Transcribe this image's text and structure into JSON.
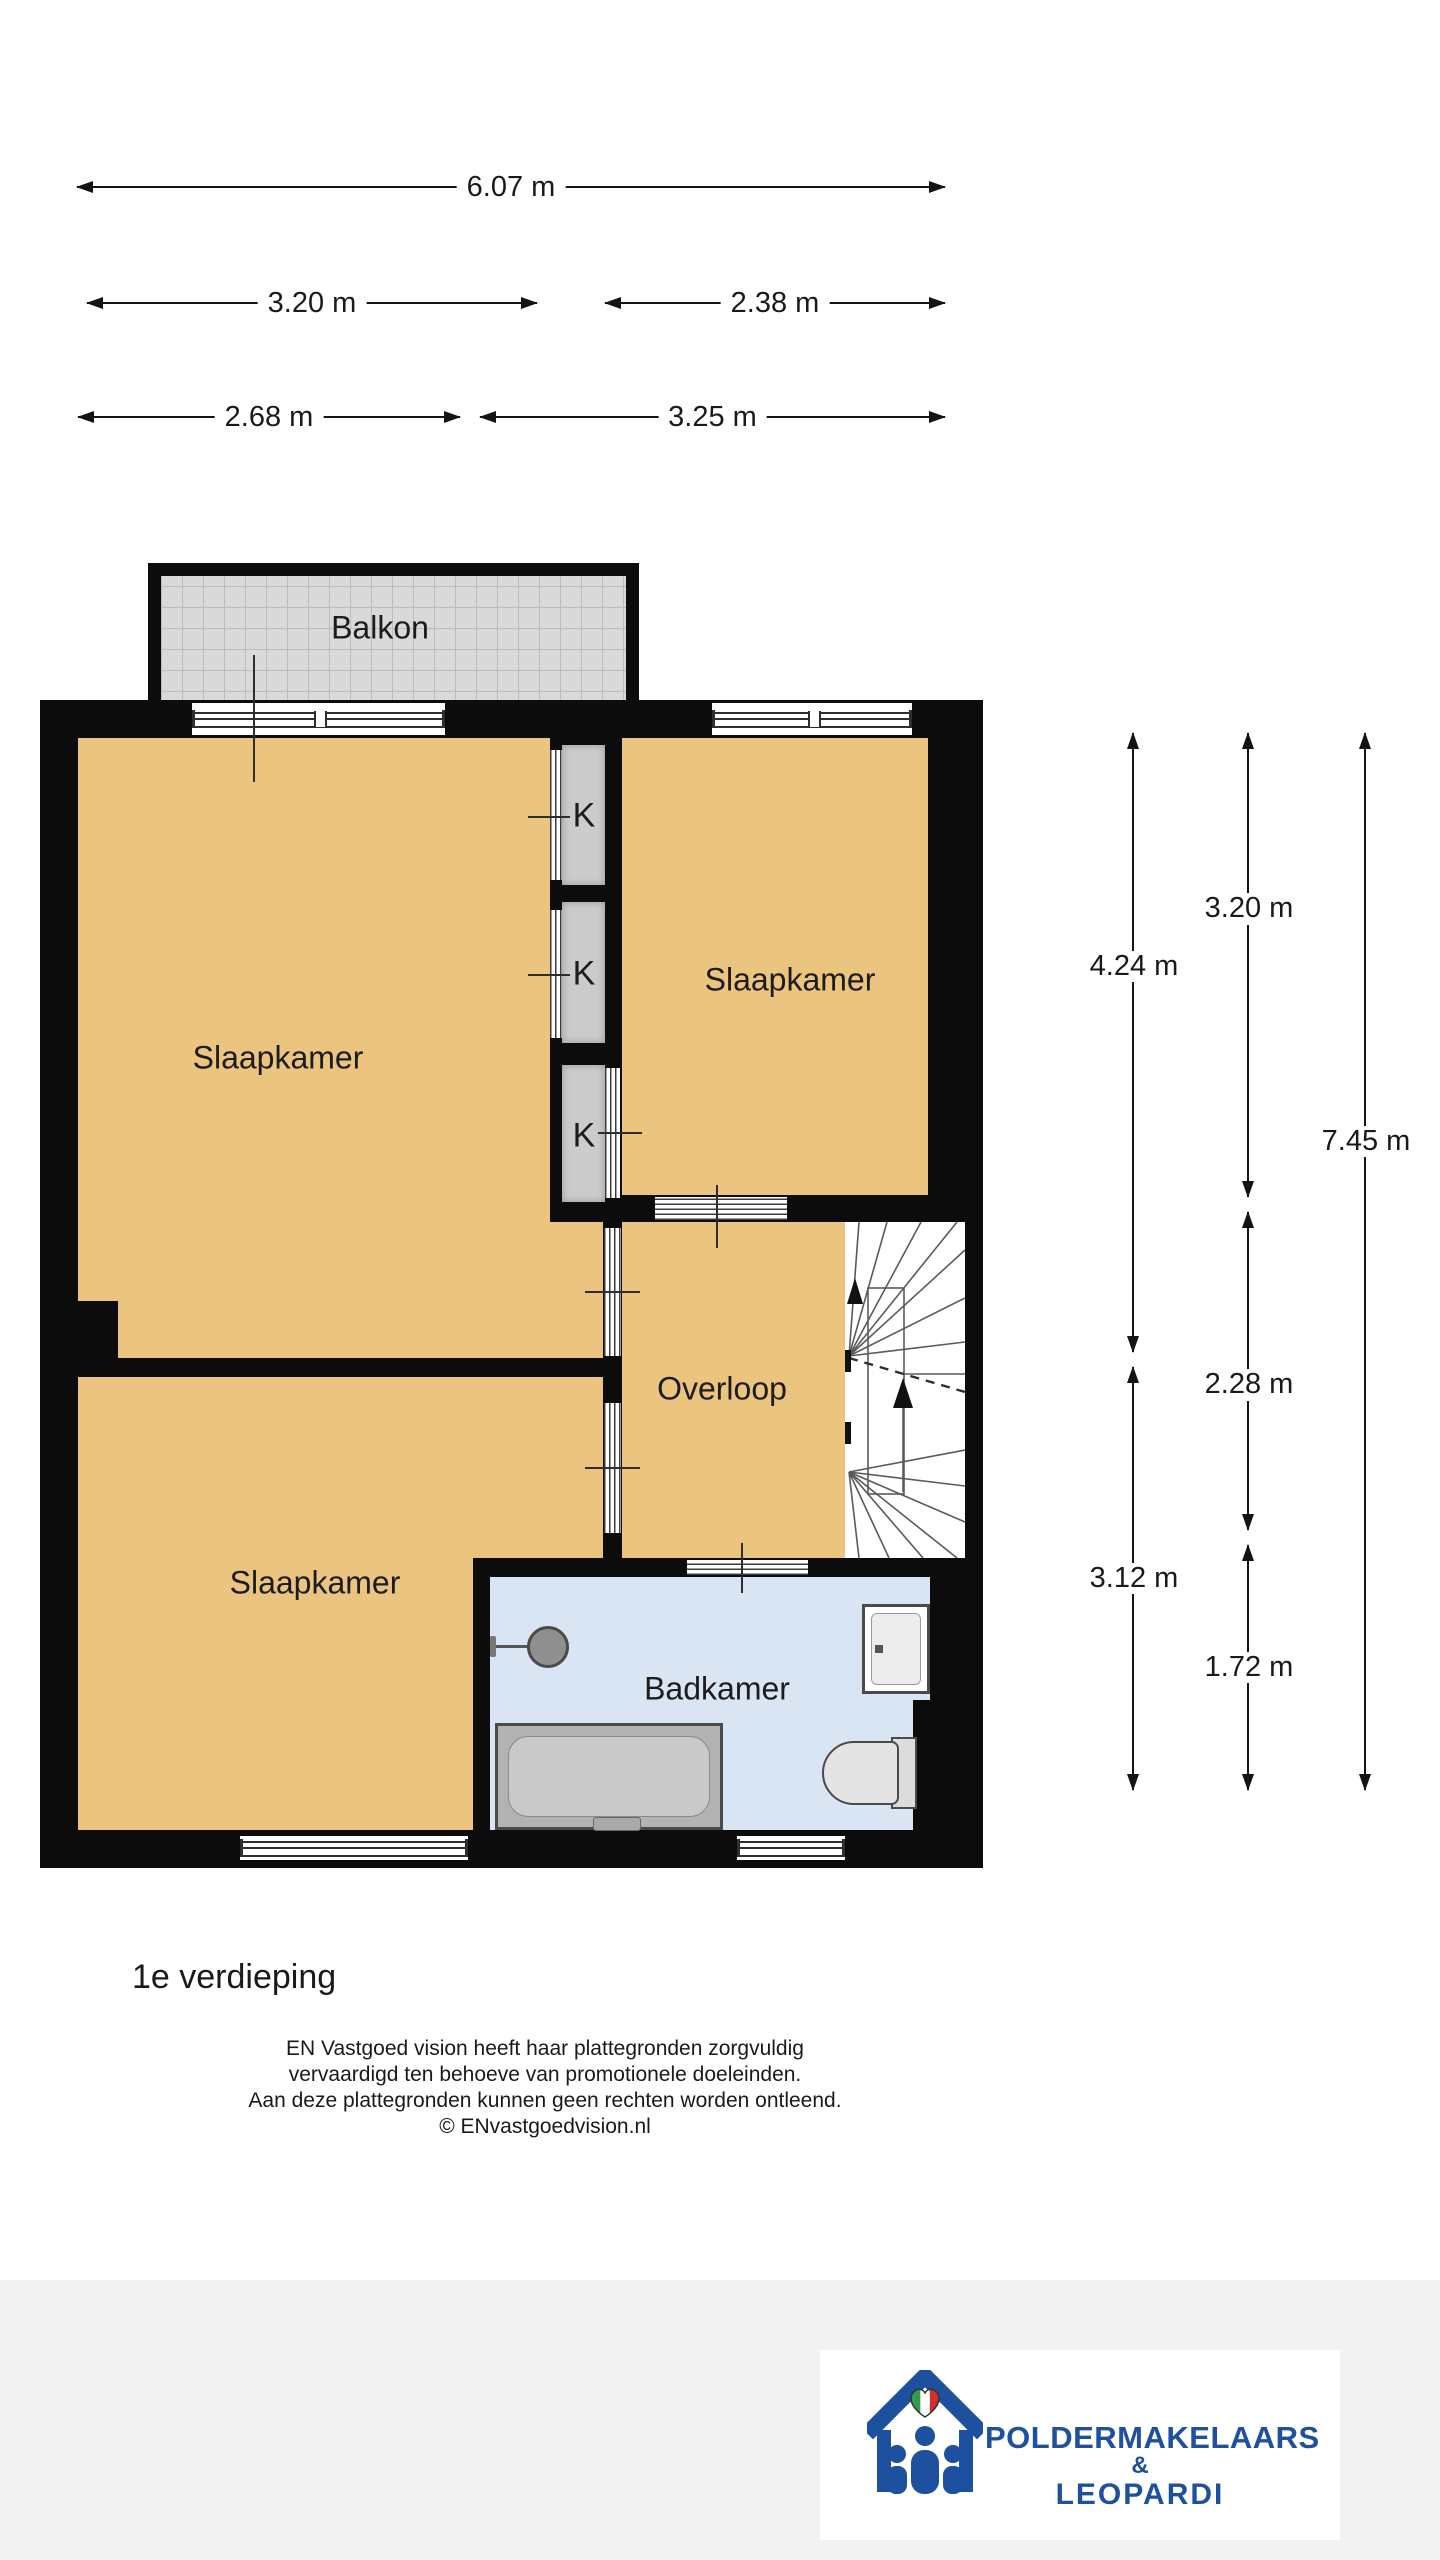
{
  "floor_plan": {
    "title": "1e verdieping",
    "rooms": {
      "balcony": "Balkon",
      "bedroom_top_left": "Slaapkamer",
      "bedroom_right": "Slaapkamer",
      "bedroom_bottom_left": "Slaapkamer",
      "landing": "Overloop",
      "bathroom": "Badkamer",
      "closet": "K"
    },
    "dimensions": {
      "horizontal": [
        "6.07 m",
        "3.20 m",
        "2.38 m",
        "2.68 m",
        "3.25 m"
      ],
      "vertical": [
        "4.24 m",
        "3.12 m",
        "3.20 m",
        "2.28 m",
        "1.72 m",
        "7.45 m"
      ]
    },
    "colors": {
      "wall": "#0c0c0c",
      "floor_rooms": "#ebc480",
      "floor_bathroom": "#d9e5f2",
      "closet": "#cbcbcb",
      "balcony_tile": "#d9d9d9",
      "logo_blue": "#1d509f",
      "heart_green": "#2f9e4e",
      "heart_red": "#d32f2f"
    }
  },
  "footer": {
    "floor_title": "1e verdieping",
    "disclaimer": [
      "EN Vastgoed vision heeft haar plattegronden zorgvuldig",
      "vervaardigd ten behoeve van promotionele doeleinden.",
      "Aan deze plattegronden kunnen geen rechten worden ontleend.",
      "© ENvastgoedvision.nl"
    ]
  },
  "logo": {
    "line1": "POLDERMAKELAARS",
    "amp": "&",
    "line2": "LEOPARDI"
  }
}
